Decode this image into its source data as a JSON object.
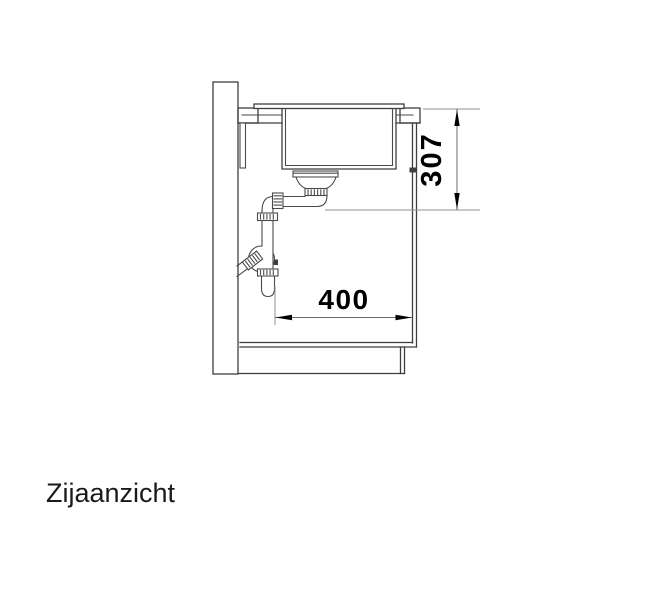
{
  "drawing": {
    "label": "Zijaanzicht",
    "dimensions": {
      "vertical": {
        "value": "307",
        "orientation": "vertical",
        "location": "right-of-sink"
      },
      "horizontal": {
        "value": "400",
        "orientation": "horizontal",
        "location": "inside-cabinet"
      }
    },
    "colors": {
      "background": "#ffffff",
      "main_line": "#3f3f3f",
      "dimension_line": "#6b6b6b",
      "extension_line": "#8f8f8f",
      "text": "#000000"
    }
  }
}
